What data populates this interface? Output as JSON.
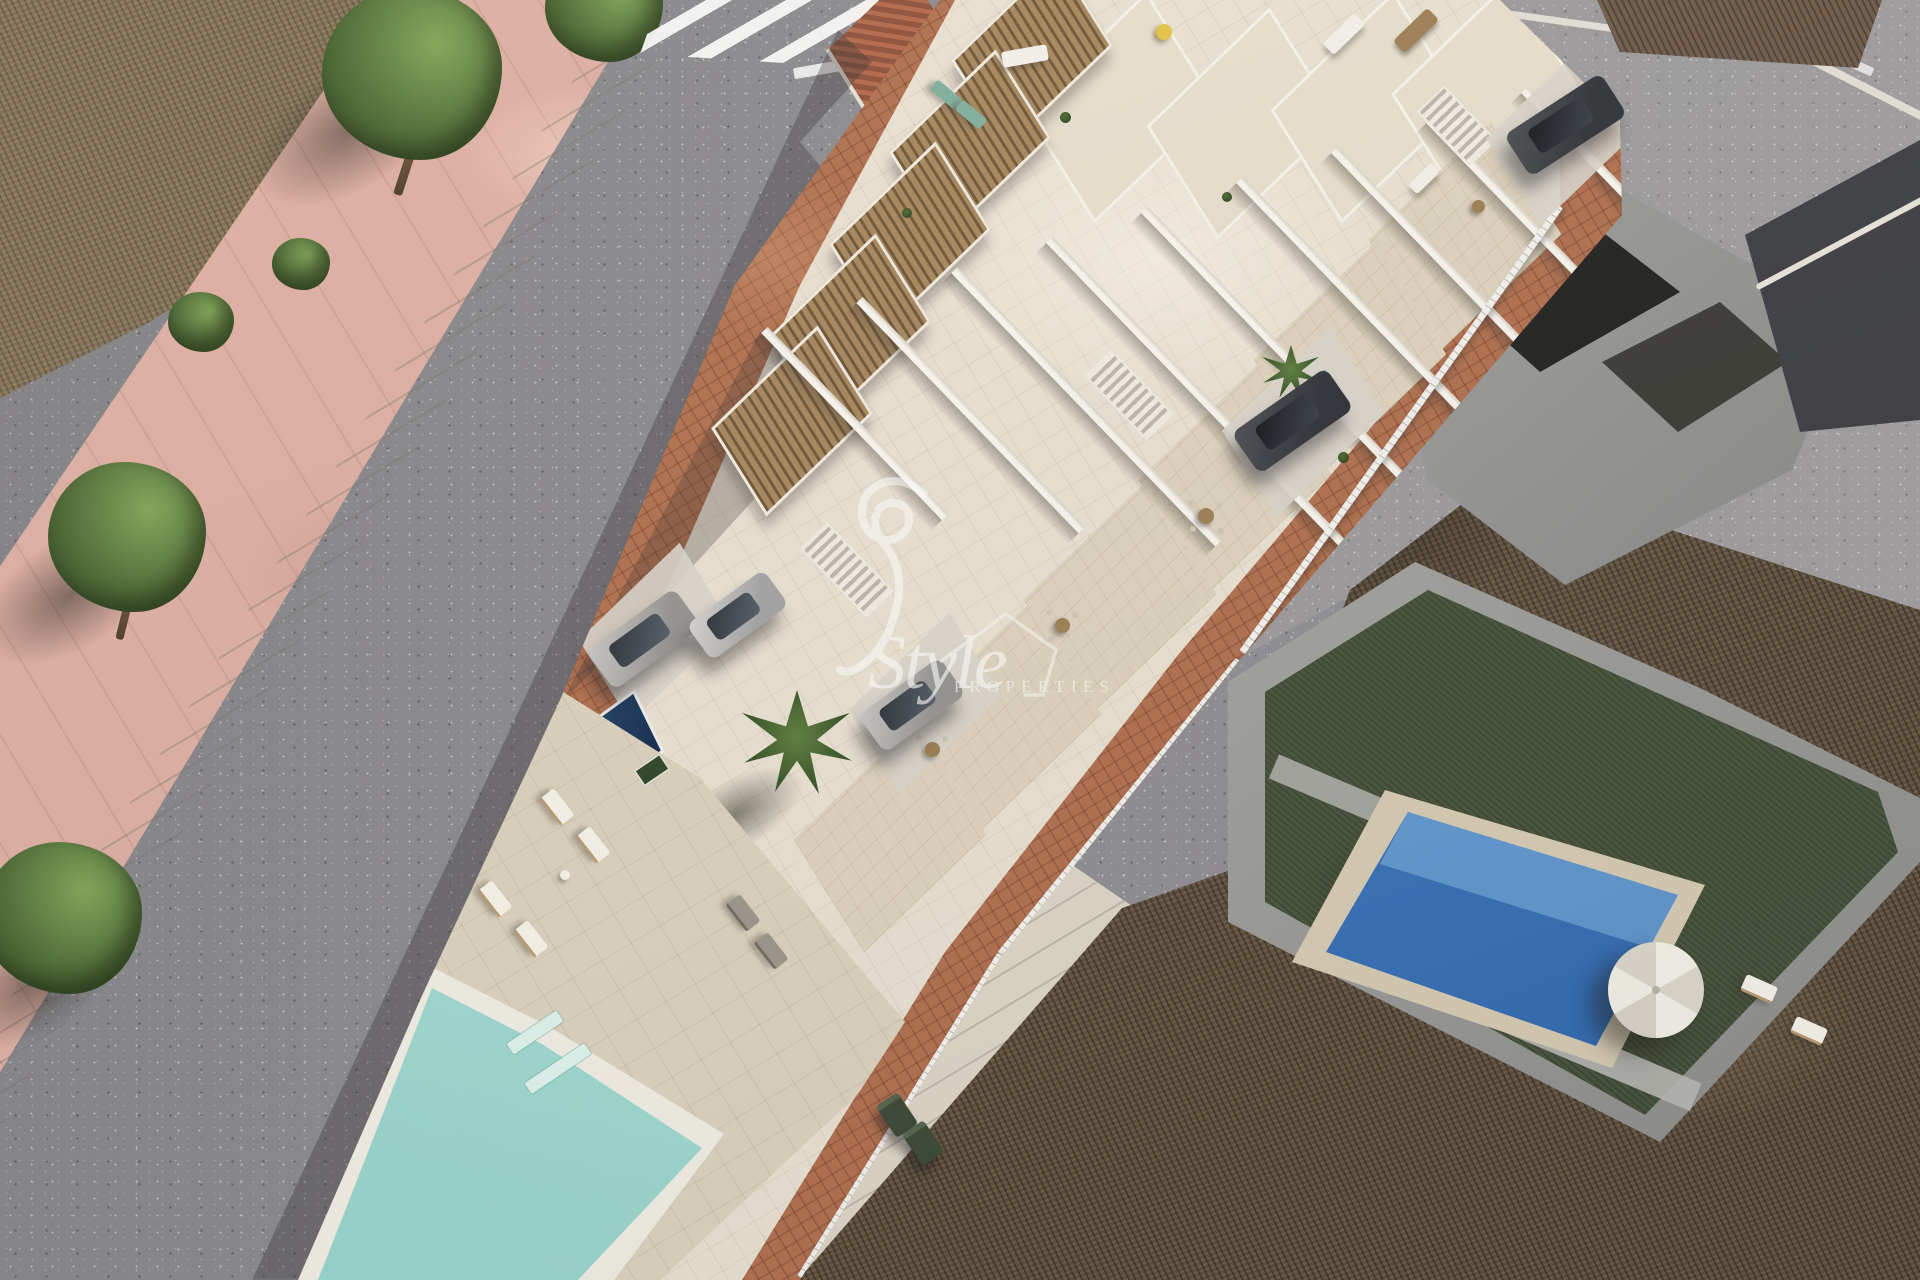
{
  "watermark": {
    "script_word": "Style",
    "caps_word": "PROPERTIES"
  },
  "palette": {
    "asphalt_grey": "#8e8d91",
    "sidewalk_pink": "#dcaea1",
    "curb_white": "#e6e2d6",
    "terracotta_paving": "#b06f4d",
    "plaster_white": "#f2ede3",
    "terrace_beige": "#ddd3bd",
    "pergola_wood": "#8a6c44",
    "community_pool_turquoise": "#a7ded4",
    "private_plunge_pool_navy": "#1c3a66",
    "neighbor_pool_blue": "#3a77bd",
    "lawn_green": "#47523a",
    "scrub_brown": "#5c4e3c",
    "tree_green": "#4c6b33",
    "watermark_white": "#ffffff"
  },
  "scene": {
    "description": "Aerial 3D render of a new-build row of white townhouses with wooden pergola roof terraces and a shared wedge-shaped turquoise pool, bordered by asphalt roads with a zebra crossing, pink pavement with trees, an existing villa with blue pool, lawn and parasol, older grey buildings and dry scrubland.",
    "objects": [
      "asphalt-road",
      "zebra-crosswalk",
      "stop-line",
      "pink-sidewalk",
      "street-trees",
      "dry-scrubland",
      "townhouse-row",
      "wood-pergolas",
      "roof-terraces",
      "party-walls",
      "white-railings",
      "terracotta-pavement",
      "community-pool",
      "sun-loungers",
      "private-plunge-pool",
      "palm-trees",
      "parked-cars",
      "trash-bins",
      "neighbor-villa",
      "villa-lawn",
      "villa-pool",
      "white-parasol",
      "old-terracotta-roof",
      "dark-roof-building",
      "style-properties-watermark"
    ]
  }
}
